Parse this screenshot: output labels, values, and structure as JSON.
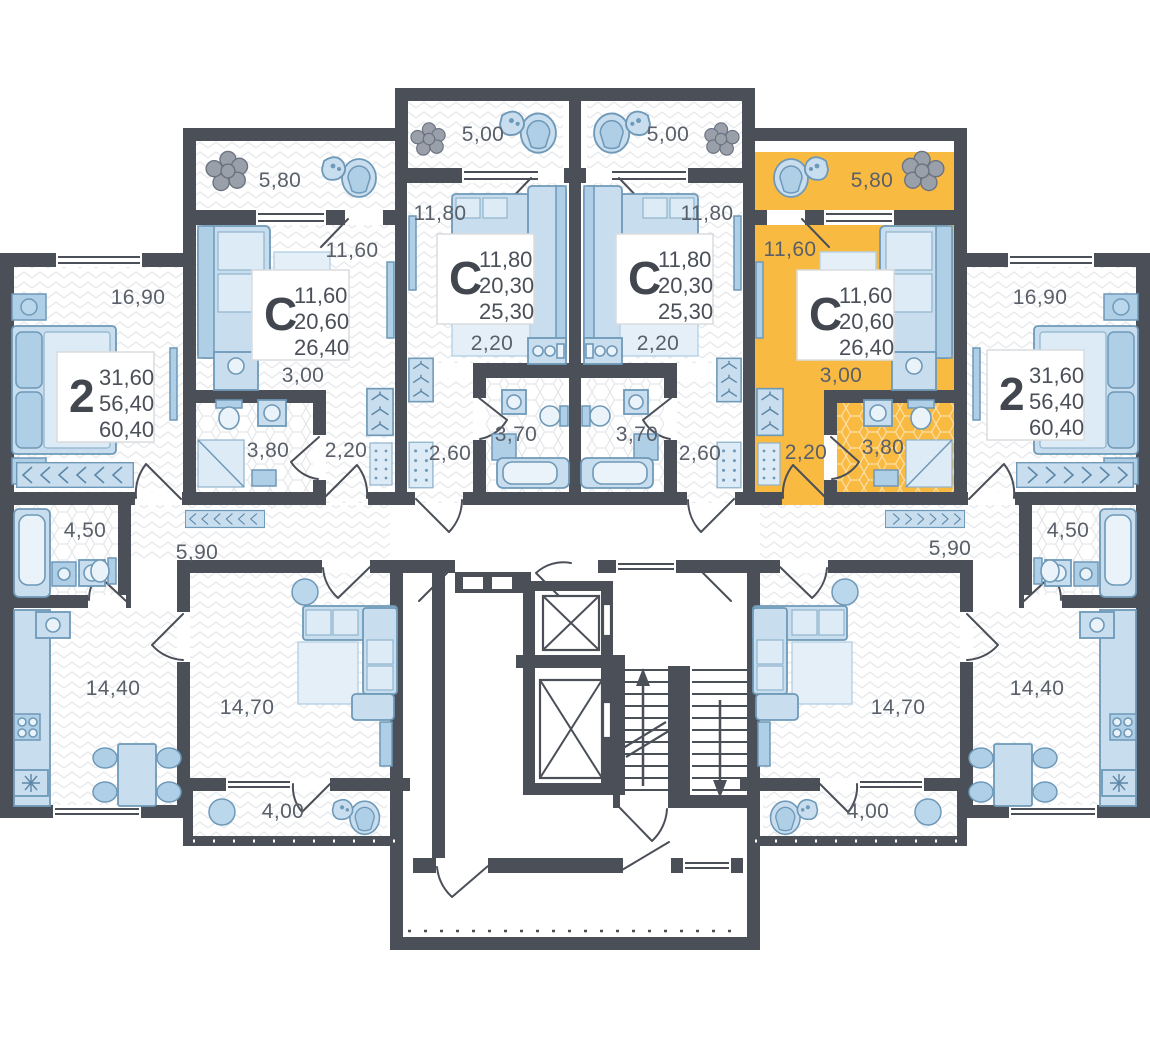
{
  "page": {
    "background": "#FFFFFF"
  },
  "plan": {
    "colors": {
      "wall": "#4A4F58",
      "highlight": "#F9BA42",
      "furniture": "#C8DEEF",
      "furniture_stroke": "#6E99B8",
      "label_text": "#5A6069",
      "card_text": "#41464F"
    },
    "highlighted_apartment": {
      "type": "С",
      "area_living": "11,60",
      "area_main": "20,60",
      "area_total": "26,40"
    },
    "apartments": [
      {
        "type": "2",
        "lines": [
          "31,60",
          "56,40",
          "60,40"
        ],
        "x": 57,
        "y": 352,
        "highlighted": false
      },
      {
        "type": "С",
        "lines": [
          "11,60",
          "20,60",
          "26,40"
        ],
        "x": 252,
        "y": 270,
        "highlighted": false
      },
      {
        "type": "С",
        "lines": [
          "11,80",
          "20,30",
          "25,30"
        ],
        "x": 437,
        "y": 234,
        "highlighted": false
      },
      {
        "type": "С",
        "lines": [
          "11,80",
          "20,30",
          "25,30"
        ],
        "x": 616,
        "y": 234,
        "highlighted": false
      },
      {
        "type": "С",
        "lines": [
          "11,60",
          "20,60",
          "26,40"
        ],
        "x": 797,
        "y": 270,
        "highlighted": true
      },
      {
        "type": "2",
        "lines": [
          "31,60",
          "56,40",
          "60,40"
        ],
        "x": 987,
        "y": 350,
        "highlighted": false
      }
    ],
    "room_labels": [
      {
        "text": "5,80",
        "x": 280,
        "y": 187
      },
      {
        "text": "5,00",
        "x": 483,
        "y": 141
      },
      {
        "text": "5,00",
        "x": 668,
        "y": 141
      },
      {
        "text": "5,80",
        "x": 872,
        "y": 187
      },
      {
        "text": "16,90",
        "x": 138,
        "y": 304
      },
      {
        "text": "11,60",
        "x": 352,
        "y": 257
      },
      {
        "text": "11,80",
        "x": 440,
        "y": 220
      },
      {
        "text": "11,80",
        "x": 707,
        "y": 220
      },
      {
        "text": "11,60",
        "x": 790,
        "y": 256
      },
      {
        "text": "16,90",
        "x": 1040,
        "y": 304
      },
      {
        "text": "3,00",
        "x": 303,
        "y": 382
      },
      {
        "text": "3,00",
        "x": 841,
        "y": 382
      },
      {
        "text": "2,20",
        "x": 492,
        "y": 350
      },
      {
        "text": "2,20",
        "x": 658,
        "y": 350
      },
      {
        "text": "3,80",
        "x": 268,
        "y": 457
      },
      {
        "text": "2,20",
        "x": 346,
        "y": 457
      },
      {
        "text": "3,70",
        "x": 516,
        "y": 441
      },
      {
        "text": "2,60",
        "x": 450,
        "y": 460
      },
      {
        "text": "2,60",
        "x": 700,
        "y": 460
      },
      {
        "text": "3,70",
        "x": 637,
        "y": 441
      },
      {
        "text": "2,20",
        "x": 806,
        "y": 459
      },
      {
        "text": "3,80",
        "x": 883,
        "y": 454
      },
      {
        "text": "4,50",
        "x": 85,
        "y": 537
      },
      {
        "text": "5,90",
        "x": 197,
        "y": 559
      },
      {
        "text": "5,90",
        "x": 950,
        "y": 555
      },
      {
        "text": "4,50",
        "x": 1068,
        "y": 537
      },
      {
        "text": "14,40",
        "x": 113,
        "y": 695
      },
      {
        "text": "14,70",
        "x": 247,
        "y": 714
      },
      {
        "text": "14,70",
        "x": 898,
        "y": 714
      },
      {
        "text": "14,40",
        "x": 1037,
        "y": 695
      },
      {
        "text": "4,00",
        "x": 283,
        "y": 818
      },
      {
        "text": "4,00",
        "x": 868,
        "y": 818
      }
    ]
  }
}
